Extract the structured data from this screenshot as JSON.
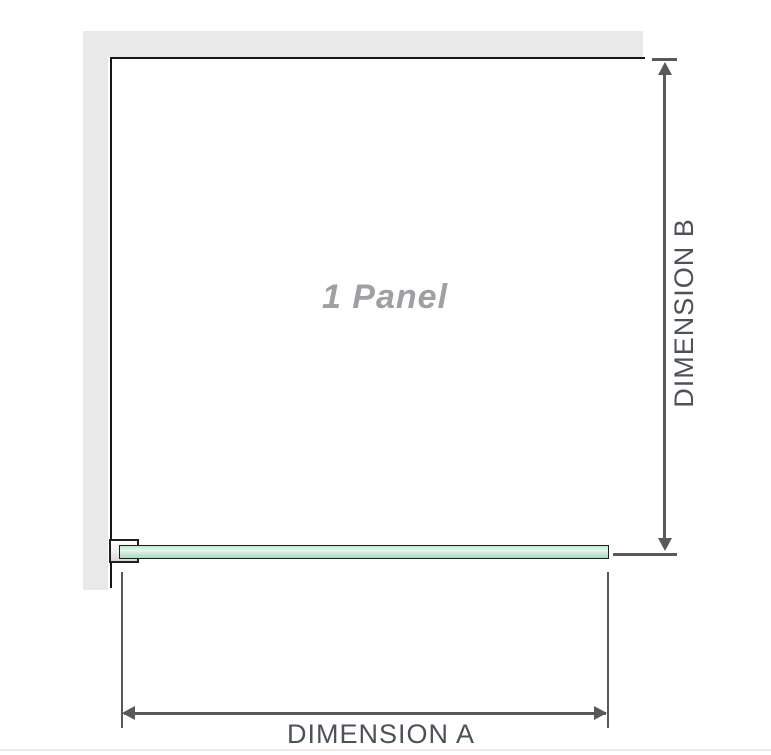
{
  "diagram": {
    "panel_label": "1 Panel",
    "dimension_a_label": "DIMENSION A",
    "dimension_b_label": "DIMENSION B",
    "colors": {
      "wall": "#e9e9e9",
      "panel_outline": "#171717",
      "dimension_line": "#595959",
      "dimension_label_text": "#4d5158",
      "panel_label_text": "#a0a0a4",
      "glass_green_light": "#e9f7ef",
      "glass_green": "#a9dabf",
      "bracket_fill": "#d8d8d8",
      "bottom_rule": "#f1e9e9"
    }
  }
}
